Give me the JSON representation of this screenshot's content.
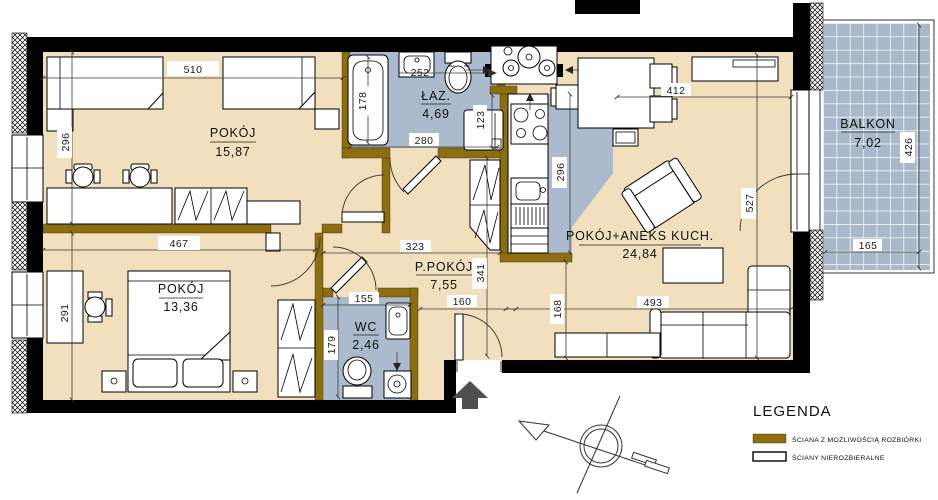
{
  "rooms": {
    "room1": {
      "label": "POKÓJ",
      "area": "15,87"
    },
    "room2": {
      "label": "POKÓJ",
      "area": "13,36"
    },
    "bathroom": {
      "label": "ŁAZ.",
      "area": "4,69"
    },
    "wc": {
      "label": "WC",
      "area": "2,46"
    },
    "hall": {
      "label": "P.POKÓJ",
      "area": "7,55"
    },
    "living": {
      "label": "POKÓJ+ANEKS KUCH.",
      "area": "24,84"
    },
    "balcony": {
      "label": "BALKON",
      "area": "7,02"
    }
  },
  "dims": {
    "room1_width": "510",
    "room1_depth": "296",
    "room2_width": "467",
    "room2_depth": "291",
    "tub": "178",
    "sink": "252",
    "bath_width": "280",
    "washer": "123",
    "kitchen_depth": "296",
    "living_width": "412",
    "living_depth": "527",
    "balcony_depth": "426",
    "balcony_width": "165",
    "hall_width": "323",
    "hall_depth": "341",
    "wc_width": "155",
    "wc_depth": "179",
    "entry": "160",
    "sofa_gap": "168",
    "living_width2": "493"
  },
  "legend": {
    "title": "LEGENDA",
    "items": [
      {
        "label": "ŚCIANA Z MOŻLIWOŚCIĄ ROZBIÓRKI",
        "swatch": "demolishable"
      },
      {
        "label": "ŚCIANY NIEROZBIERALNE",
        "swatch": "load-bearing"
      }
    ]
  },
  "colors": {
    "floor": "#f1dfbe",
    "wet_floor": "#abbacc",
    "balcony_tile": "#a9b8ca",
    "demolishable_wall": "#8c6d10",
    "wall": "#000000"
  }
}
